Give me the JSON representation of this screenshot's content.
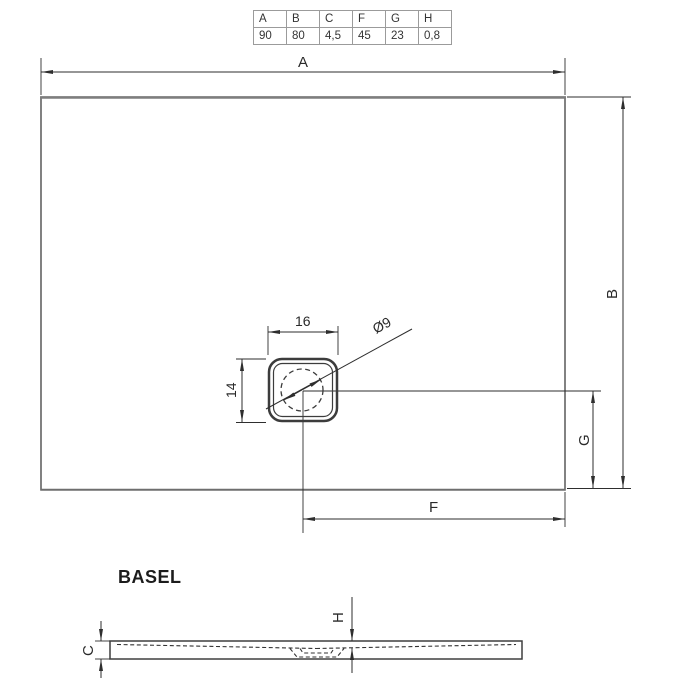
{
  "spec_table": {
    "headers": [
      "A",
      "B",
      "C",
      "F",
      "G",
      "H"
    ],
    "values": [
      "90",
      "80",
      "4,5",
      "45",
      "23",
      "0,8"
    ]
  },
  "model": {
    "name": "BASEL"
  },
  "plan_view": {
    "width_label": "A",
    "height_label": "B",
    "drain_to_right_edge_label": "F",
    "drain_to_bottom_edge_label": "G",
    "drain_width": "16",
    "drain_height": "14",
    "drain_diameter": "Ø9"
  },
  "section_view": {
    "edge_height_label": "C",
    "slope_depth_label": "H"
  },
  "colors": {
    "line": "#2e2e2e",
    "outline_heavy": "#7e7e7e",
    "table_border": "#9b9b9b",
    "background": "#ffffff"
  }
}
